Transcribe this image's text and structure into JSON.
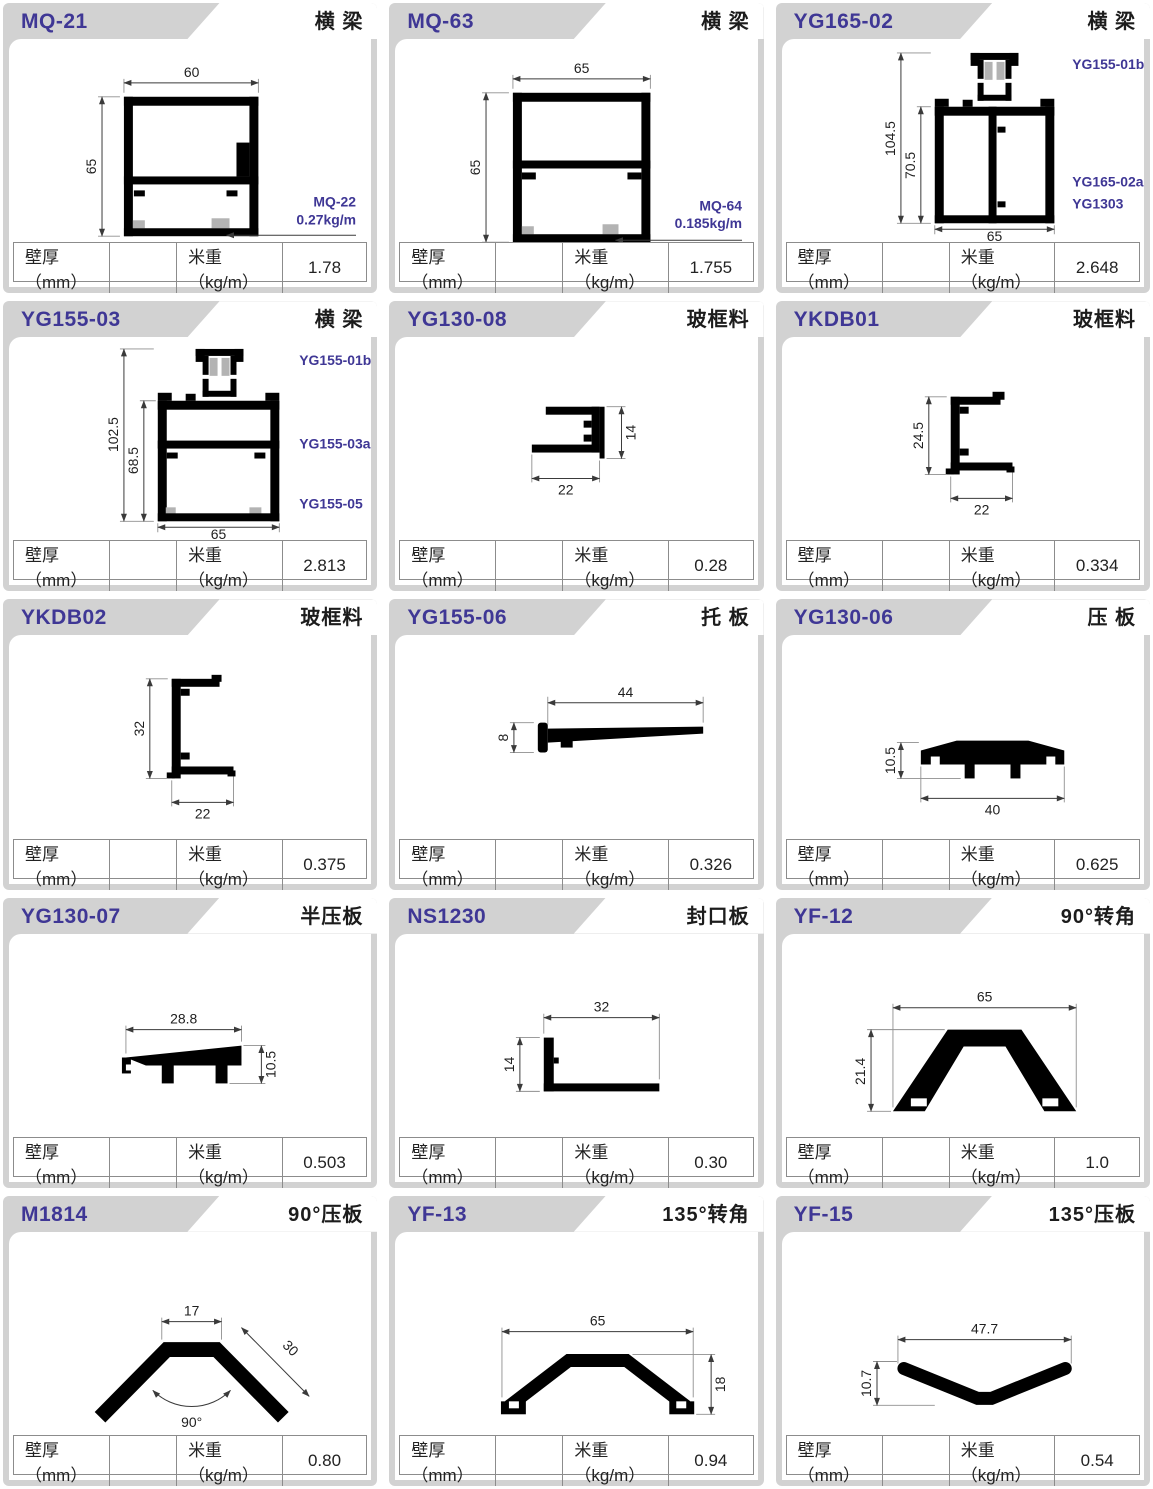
{
  "theme": {
    "accent": "#3f3795",
    "band_gray": "#d2d2d2",
    "table_border": "#8c8c8c",
    "profile_black": "#000000"
  },
  "footer": {
    "t1": "壁厚（mm）",
    "t2": "米重（kg/m）"
  },
  "cards": [
    {
      "code": "MQ-21",
      "category": "横 梁",
      "wall": "",
      "weight": "1.78",
      "dims": {
        "w": "60",
        "h": "65"
      },
      "sub": {
        "code": "MQ-22",
        "weight": "0.27kg/m"
      }
    },
    {
      "code": "MQ-63",
      "category": "横 梁",
      "wall": "",
      "weight": "1.755",
      "dims": {
        "w": "65",
        "h": "65"
      },
      "sub": {
        "code": "MQ-64",
        "weight": "0.185kg/m"
      }
    },
    {
      "code": "YG165-02",
      "category": "横 梁",
      "wall": "",
      "weight": "2.648",
      "dims": {
        "h1": "104.5",
        "h2": "70.5",
        "w": "65"
      },
      "labels": [
        "YG155-01b",
        "YG165-02a",
        "YG1303"
      ]
    },
    {
      "code": "YG155-03",
      "category": "横 梁",
      "wall": "",
      "weight": "2.813",
      "dims": {
        "h1": "102.5",
        "h2": "68.5",
        "w": "65"
      },
      "labels": [
        "YG155-01b",
        "YG155-03a",
        "YG155-05"
      ]
    },
    {
      "code": "YG130-08",
      "category": "玻框料",
      "wall": "",
      "weight": "0.28",
      "dims": {
        "w": "22",
        "h": "14"
      }
    },
    {
      "code": "YKDB01",
      "category": "玻框料",
      "wall": "",
      "weight": "0.334",
      "dims": {
        "h": "24.5",
        "w": "22"
      }
    },
    {
      "code": "YKDB02",
      "category": "玻框料",
      "wall": "",
      "weight": "0.375",
      "dims": {
        "h": "32",
        "w": "22"
      }
    },
    {
      "code": "YG155-06",
      "category": "托 板",
      "wall": "",
      "weight": "0.326",
      "dims": {
        "w": "44",
        "h": "8"
      }
    },
    {
      "code": "YG130-06",
      "category": "压 板",
      "wall": "",
      "weight": "0.625",
      "dims": {
        "h": "10.5",
        "w": "40"
      }
    },
    {
      "code": "YG130-07",
      "category": "半压板",
      "wall": "",
      "weight": "0.503",
      "dims": {
        "w": "28.8",
        "h": "10.5"
      }
    },
    {
      "code": "NS1230",
      "category": "封口板",
      "wall": "",
      "weight": "0.30",
      "dims": {
        "w": "32",
        "h": "14"
      }
    },
    {
      "code": "YF-12",
      "category": "90°转角",
      "wall": "",
      "weight": "1.0",
      "dims": {
        "w": "65",
        "h": "21.4"
      }
    },
    {
      "code": "M1814",
      "category": "90°压板",
      "wall": "",
      "weight": "0.80",
      "dims": {
        "top": "17",
        "side": "30",
        "angle": "90°"
      }
    },
    {
      "code": "YF-13",
      "category": "135°转角",
      "wall": "",
      "weight": "0.94",
      "dims": {
        "w": "65",
        "h": "18"
      }
    },
    {
      "code": "YF-15",
      "category": "135°压板",
      "wall": "",
      "weight": "0.54",
      "dims": {
        "w": "47.7",
        "h": "10.7"
      }
    }
  ]
}
